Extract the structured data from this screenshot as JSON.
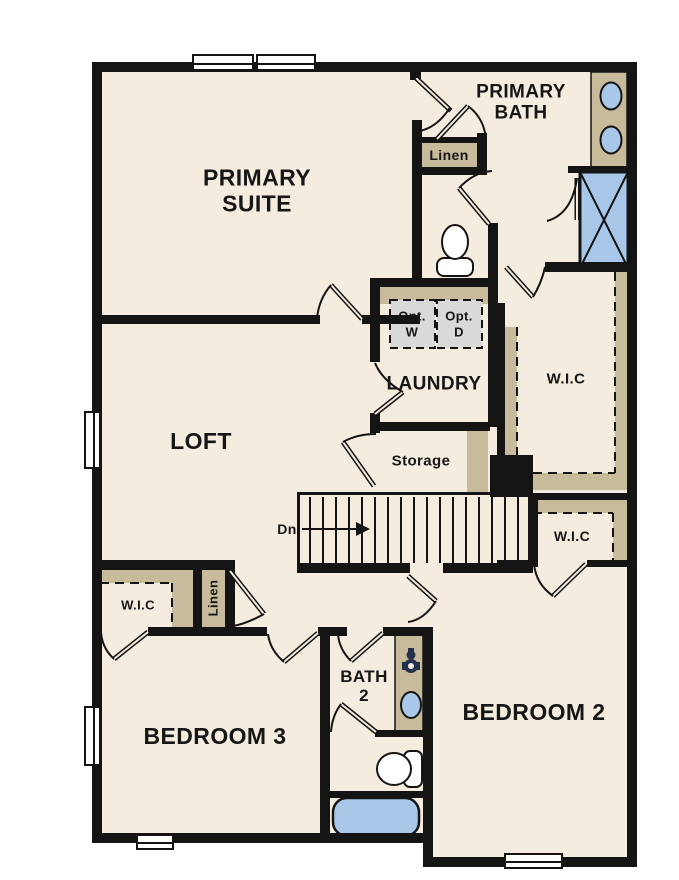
{
  "plan_title": "Second floor residential floor plan",
  "labels": {
    "primary_suite": "PRIMARY\nSUITE",
    "primary_bath": "PRIMARY\nBATH",
    "linen_upper": "Linen",
    "opt_washer": "Opt.\nW",
    "opt_dryer": "Opt.\nD",
    "laundry": "LAUNDRY",
    "wic_primary": "W.I.C",
    "storage": "Storage",
    "stairs_dn": "Dn",
    "wic_hall": "W.I.C",
    "wic_bed3": "W.I.C",
    "linen_bed3": "Linen",
    "loft": "LOFT",
    "bath2": "BATH\n2",
    "bedroom3": "BEDROOM 3",
    "bedroom2": "BEDROOM 2"
  },
  "fixtures": [
    "double-vanity-sinks",
    "shower",
    "toilet-primary",
    "washer-dryer-optional",
    "bath2-vanity-sink",
    "bath2-faucet",
    "toilet-bath2",
    "bathtub"
  ],
  "windows": {
    "top_double": 2,
    "left": 2,
    "bottom": 2
  },
  "stairs": {
    "direction": "Dn",
    "treads": 17
  },
  "colors": {
    "floor": "#F4EDDF",
    "wall": "#141414",
    "cabinet_tan": "#C8BB9B",
    "fixture_blue": "#A9C8E9",
    "appliance_gray": "#D9D9D9",
    "text": "#161616",
    "background": "#FFFFFF"
  }
}
